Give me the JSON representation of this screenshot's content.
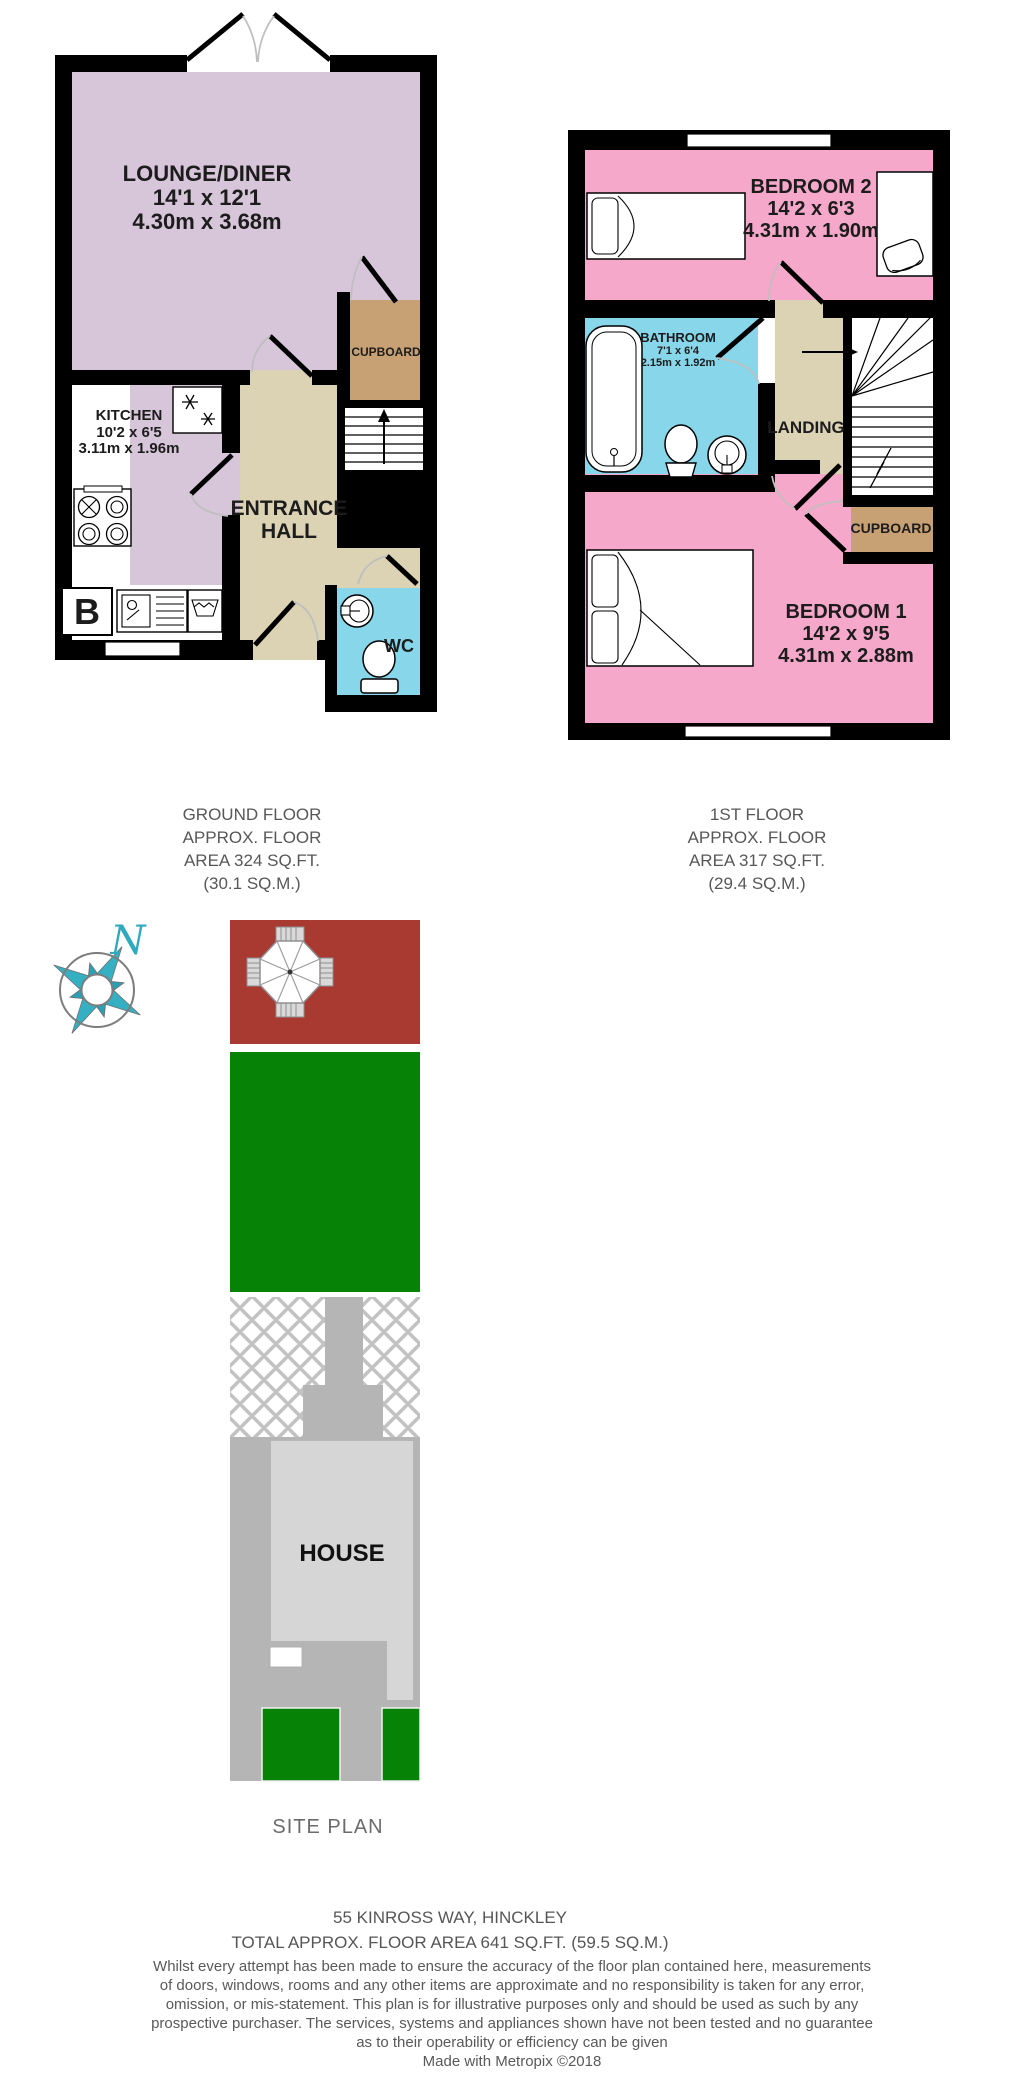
{
  "ground_floor": {
    "rooms": {
      "lounge": {
        "name": "LOUNGE/DINER",
        "size_imperial": "14'1 x 12'1",
        "size_metric": "4.30m x 3.68m"
      },
      "kitchen": {
        "name": "KITCHEN",
        "size_imperial": "10'2 x 6'5",
        "size_metric": "3.11m x 1.96m"
      },
      "entrance_hall": {
        "line1": "ENTRANCE",
        "line2": "HALL"
      },
      "cupboard": {
        "name": "CUPBOARD"
      },
      "wc": {
        "name": "WC"
      },
      "boiler": {
        "label": "B"
      }
    },
    "caption": {
      "line1": "GROUND FLOOR",
      "line2": "APPROX. FLOOR",
      "line3": "AREA 324 SQ.FT.",
      "line4": "(30.1 SQ.M.)"
    }
  },
  "first_floor": {
    "rooms": {
      "bedroom2": {
        "name": "BEDROOM 2",
        "size_imperial": "14'2 x 6'3",
        "size_metric": "4.31m x 1.90m"
      },
      "bathroom": {
        "name": "BATHROOM",
        "size_imperial": "7'1 x 6'4",
        "size_metric": "2.15m x 1.92m"
      },
      "landing": {
        "name": "LANDING"
      },
      "cupboard": {
        "name": "CUPBOARD"
      },
      "bedroom1": {
        "name": "BEDROOM 1",
        "size_imperial": "14'2 x 9'5",
        "size_metric": "4.31m x 2.88m"
      }
    },
    "caption": {
      "line1": "1ST FLOOR",
      "line2": "APPROX. FLOOR",
      "line3": "AREA 317 SQ.FT.",
      "line4": "(29.4 SQ.M.)"
    }
  },
  "site_plan": {
    "compass_label": "N",
    "house_label": "HOUSE",
    "caption": "SITE PLAN"
  },
  "footer": {
    "address": "55 KINROSS WAY, HINCKLEY",
    "total_area": "TOTAL APPROX. FLOOR AREA 641 SQ.FT. (59.5 SQ.M.)",
    "disclaimer_lines": [
      "Whilst every attempt has been made to ensure the accuracy of the floor plan contained here, measurements",
      "of doors, windows, rooms and any other items are approximate and no responsibility is taken for any error,",
      "omission, or mis-statement. This plan is for illustrative purposes only and should be used as such by any",
      "prospective purchaser. The services, systems and appliances shown have not been tested and no guarantee",
      "as to their operability or efficiency can be given"
    ],
    "credit": "Made with Metropix ©2018"
  },
  "colors": {
    "wall": "#000000",
    "lounge_kitchen_floor": "#d7c5d9",
    "hall_landing_floor": "#dcd2b4",
    "cupboard_floor": "#c7a173",
    "bathroom_wc_floor": "#87d6e9",
    "bedroom_floor": "#f6a8ca",
    "patio": "#a93a32",
    "lawn": "#068306",
    "driveway": "#b5b5b5",
    "house": "#d6d6d6",
    "compass": "#2fa9bd",
    "room_label_text": "#1c1c1c",
    "caption_text": "#575757"
  }
}
